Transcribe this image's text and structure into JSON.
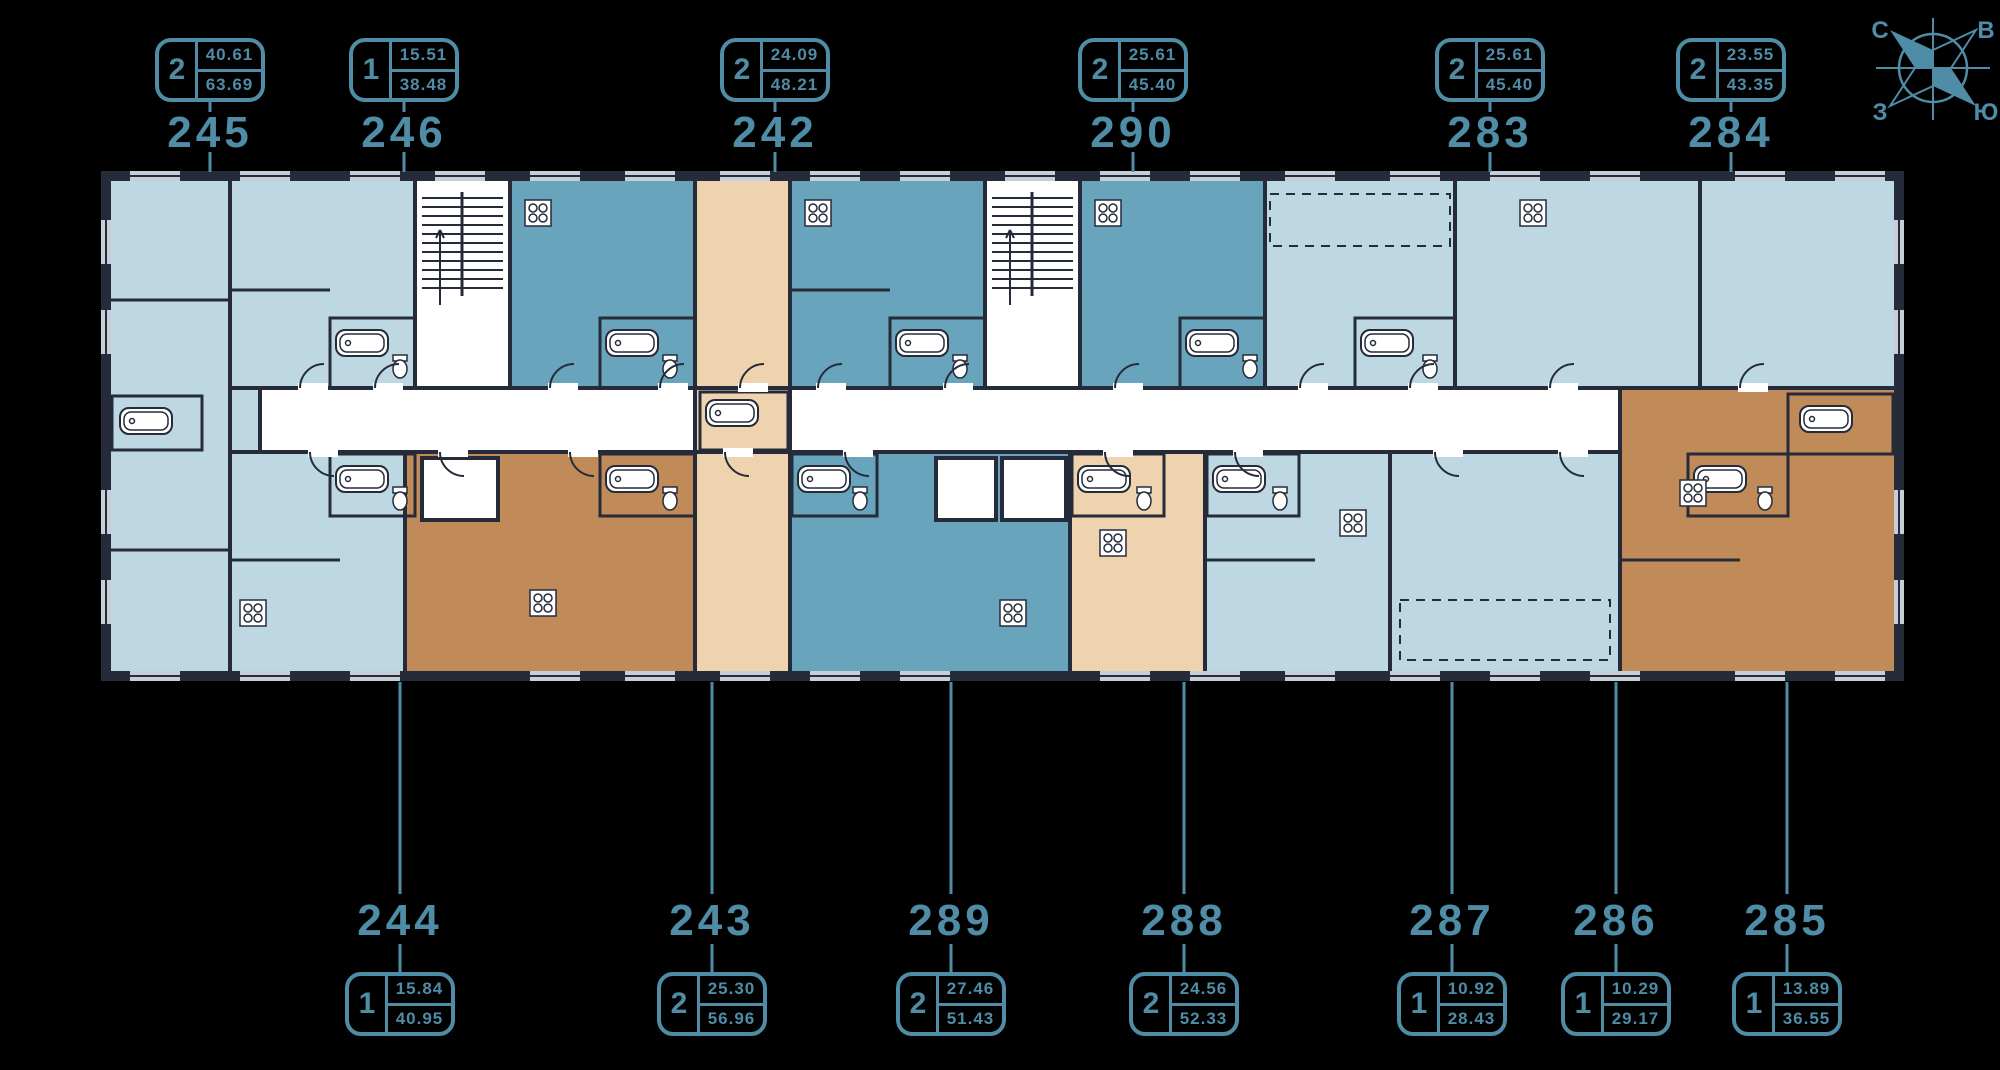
{
  "page": {
    "background": "#000000"
  },
  "colors": {
    "accent_teal": "#4f8ca6",
    "wall_dark": "#262b3a",
    "apartment_light_blue": "#bed8e3",
    "apartment_medium_blue": "#68a4bb",
    "apartment_light_tan": "#eed3ae",
    "apartment_medium_tan": "#c08a59",
    "corridor_white": "#ffffff"
  },
  "compass": {
    "north": "С",
    "east": "В",
    "west": "З",
    "south": "Ю"
  },
  "units_top": [
    {
      "unit": "245",
      "rooms": "2",
      "living_area": "40.61",
      "total_area": "63.69",
      "x": 210
    },
    {
      "unit": "246",
      "rooms": "1",
      "living_area": "15.51",
      "total_area": "38.48",
      "x": 404
    },
    {
      "unit": "242",
      "rooms": "2",
      "living_area": "24.09",
      "total_area": "48.21",
      "x": 775
    },
    {
      "unit": "290",
      "rooms": "2",
      "living_area": "25.61",
      "total_area": "45.40",
      "x": 1133
    },
    {
      "unit": "283",
      "rooms": "2",
      "living_area": "25.61",
      "total_area": "45.40",
      "x": 1490
    },
    {
      "unit": "284",
      "rooms": "2",
      "living_area": "23.55",
      "total_area": "43.35",
      "x": 1731
    }
  ],
  "units_bottom": [
    {
      "unit": "244",
      "rooms": "1",
      "living_area": "15.84",
      "total_area": "40.95",
      "x": 400
    },
    {
      "unit": "243",
      "rooms": "2",
      "living_area": "25.30",
      "total_area": "56.96",
      "x": 712
    },
    {
      "unit": "289",
      "rooms": "2",
      "living_area": "27.46",
      "total_area": "51.43",
      "x": 951
    },
    {
      "unit": "288",
      "rooms": "2",
      "living_area": "24.56",
      "total_area": "52.33",
      "x": 1184
    },
    {
      "unit": "287",
      "rooms": "1",
      "living_area": "10.92",
      "total_area": "28.43",
      "x": 1452
    },
    {
      "unit": "286",
      "rooms": "1",
      "living_area": "10.29",
      "total_area": "29.17",
      "x": 1616
    },
    {
      "unit": "285",
      "rooms": "1",
      "living_area": "13.89",
      "total_area": "36.55",
      "x": 1787
    }
  ]
}
